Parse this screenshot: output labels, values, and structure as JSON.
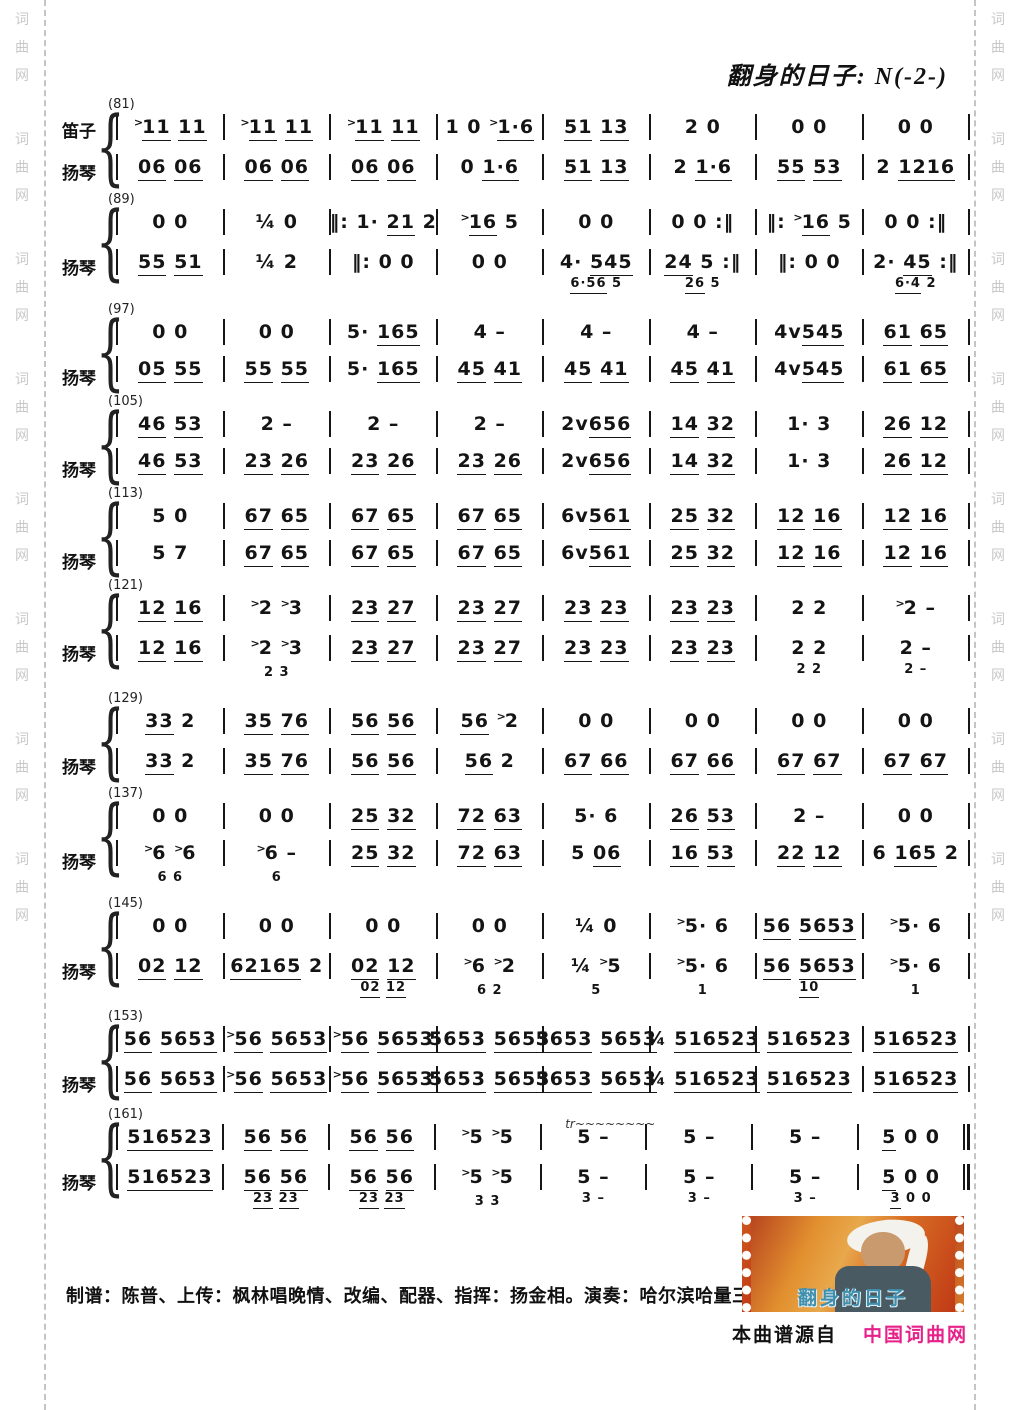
{
  "title": "翻身的日子: N(-2-)",
  "watermark": {
    "text": "词曲网"
  },
  "colors": {
    "accent_pink": "#e6218a",
    "watermark_gray": "#c9c9c9",
    "ink": "#141414"
  },
  "systems": [
    {
      "no": "(81)",
      "upper_label": "笛子",
      "lower_label": "扬琴",
      "upper": [
        ">[11] [11]",
        ">[11] [11]",
        ">[11] [11]",
        "1 0 >[1·6]",
        "[51] [13]",
        "2 0",
        "0 0",
        "0 0"
      ],
      "lower": [
        "[06] [06]",
        "[06] [06]",
        "[06] [06]",
        "0 [1·6]",
        "[51] [13]",
        "2 [1·6]",
        "[55] [53]",
        "2 [1216]"
      ]
    },
    {
      "no": "(89)",
      "upper_label": "",
      "lower_label": "扬琴",
      "upper": [
        "0 0",
        "¼ 0",
        "‖: 1· [21] 2",
        ">[16] 5",
        "0 0",
        "0 0 :‖",
        "‖: >[16] 5",
        "0 0 :‖"
      ],
      "lower": [
        "[55] [51]",
        "¼ 2",
        "‖: 0 0",
        "0 0",
        "4· [545]",
        "[24] 5 :‖",
        "‖: 0 0",
        "2· [45] :‖"
      ],
      "lower_sub": [
        "",
        "",
        "",
        "",
        "[6·56] 5",
        "[26] 5",
        "",
        "[6·4] 2"
      ]
    },
    {
      "no": "(97)",
      "upper_label": "",
      "lower_label": "扬琴",
      "upper": [
        "0 0",
        "0 0",
        "5· [165]",
        "4 –",
        "4 –",
        "4 –",
        "4v[545]",
        "[61] [65]"
      ],
      "lower": [
        "[05] [55]",
        "[55] [55]",
        "5· [165]",
        "[45] [41]",
        "[45] [41]",
        "[45] [41]",
        "4v[545]",
        "[61] [65]"
      ]
    },
    {
      "no": "(105)",
      "upper_label": "",
      "lower_label": "扬琴",
      "upper": [
        "[46] [53]",
        "2 –",
        "2 –",
        "2 –",
        "2v[656]",
        "[14] [32]",
        "1· 3",
        "[26] [12]"
      ],
      "lower": [
        "[46] [53]",
        "[23] [26]",
        "[23] [26]",
        "[23] [26]",
        "2v[656]",
        "[14] [32]",
        "1· 3",
        "[26] [12]"
      ]
    },
    {
      "no": "(113)",
      "upper_label": "",
      "lower_label": "扬琴",
      "upper": [
        "5 0",
        "[67] [65]",
        "[67] [65]",
        "[67] [65]",
        "6v[561]",
        "[25] [32]",
        "[12] [16]",
        "[12] [16]"
      ],
      "lower": [
        "5 7",
        "[67] [65]",
        "[67] [65]",
        "[67] [65]",
        "6v[561]",
        "[25] [32]",
        "[12] [16]",
        "[12] [16]"
      ]
    },
    {
      "no": "(121)",
      "upper_label": "",
      "lower_label": "扬琴",
      "upper": [
        "[12] [16]",
        ">2 >3",
        "[23] [27]",
        "[23] [27]",
        "[23] [23]",
        "[23] [23]",
        "2 2",
        ">2 –"
      ],
      "lower": [
        "[12] [16]",
        ">2 >3",
        "[23] [27]",
        "[23] [27]",
        "[23] [23]",
        "[23] [23]",
        "2 2",
        "2 –"
      ],
      "lower_sub": [
        "",
        "2 3",
        "",
        "",
        "",
        "",
        "2 2",
        "2 –"
      ]
    },
    {
      "no": "(129)",
      "upper_label": "",
      "lower_label": "扬琴",
      "upper": [
        "[33] 2",
        "[35] [76]",
        "[56] [56]",
        "[56] >2",
        "0 0",
        "0 0",
        "0 0",
        "0 0"
      ],
      "lower": [
        "[33] 2",
        "[35] [76]",
        "[56] [56]",
        "[56] 2",
        "[67] [66]",
        "[67] [66]",
        "[67] [67]",
        "[67] [67]"
      ]
    },
    {
      "no": "(137)",
      "upper_label": "",
      "lower_label": "扬琴",
      "upper": [
        "0 0",
        "0 0",
        "[25] [32]",
        "[72] [63]",
        "5· 6",
        "[26] [53]",
        "2 –",
        "0 0"
      ],
      "lower": [
        ">6 >6",
        ">6 –",
        "[25] [32]",
        "[72] [63]",
        "5 [06]",
        "[16] [53]",
        "[22] [12]",
        "6 [165] 2"
      ],
      "lower_sub": [
        "6 6",
        "6",
        "",
        "",
        "",
        "",
        "",
        ""
      ]
    },
    {
      "no": "(145)",
      "upper_label": "",
      "lower_label": "扬琴",
      "upper": [
        "0 0",
        "0 0",
        "0 0",
        "0 0",
        "¼ 0",
        ">5· 6",
        "[56] [5653]",
        ">5· 6"
      ],
      "lower": [
        "[02] [12]",
        "[62165] 2",
        "[02] [12]",
        ">6 >2",
        "¼ >5",
        ">5· 6",
        "[56] [5653]",
        ">5· 6"
      ],
      "lower_sub": [
        "",
        "",
        "[02] [12]",
        "6 2",
        "5",
        "1",
        "[10]",
        "1"
      ]
    },
    {
      "no": "(153)",
      "upper_label": "",
      "lower_label": "扬琴",
      "upper": [
        "[56] [5653]",
        ">[56] [5653]",
        ">[56] [5653]",
        "[5653] [5653]",
        "[5653] [5653]",
        "¾ [516523]",
        "[516523]",
        "[516523]"
      ],
      "lower": [
        "[56] [5653]",
        ">[56] [5653]",
        ">[56] [5653]",
        "[5653] [5653]",
        "[5653] [5653]",
        "¾ [516523]",
        "[516523]",
        "[516523]"
      ]
    },
    {
      "no": "(161)",
      "upper_label": "",
      "lower_label": "扬琴",
      "final": true,
      "annotation": "tr~~~~~~~~",
      "upper": [
        "[516523]",
        "[56] [56]",
        "[56] [56]",
        ">5 >5",
        "5 –",
        "5 –",
        "5 –",
        "[5] 0 0"
      ],
      "lower": [
        "[516523]",
        "[56] [56]",
        "[56] [56]",
        ">5 >5",
        "5 –",
        "5 –",
        "5 –",
        "[5] 0 0"
      ],
      "lower_sub": [
        "",
        "[23] [23]",
        "[23] [23]",
        "3 3",
        "3 –",
        "3 –",
        "3 –",
        "[3] 0 0"
      ]
    }
  ],
  "footer": {
    "credits": "制谱：陈普、上传：枫林唱晚情、改编、配器、指挥：扬金相。演奏：哈尔滨哈量三社区艺术团",
    "source_prefix": "本曲谱源自",
    "source_site": "中国词曲网",
    "album_title": "翻身的日子"
  }
}
